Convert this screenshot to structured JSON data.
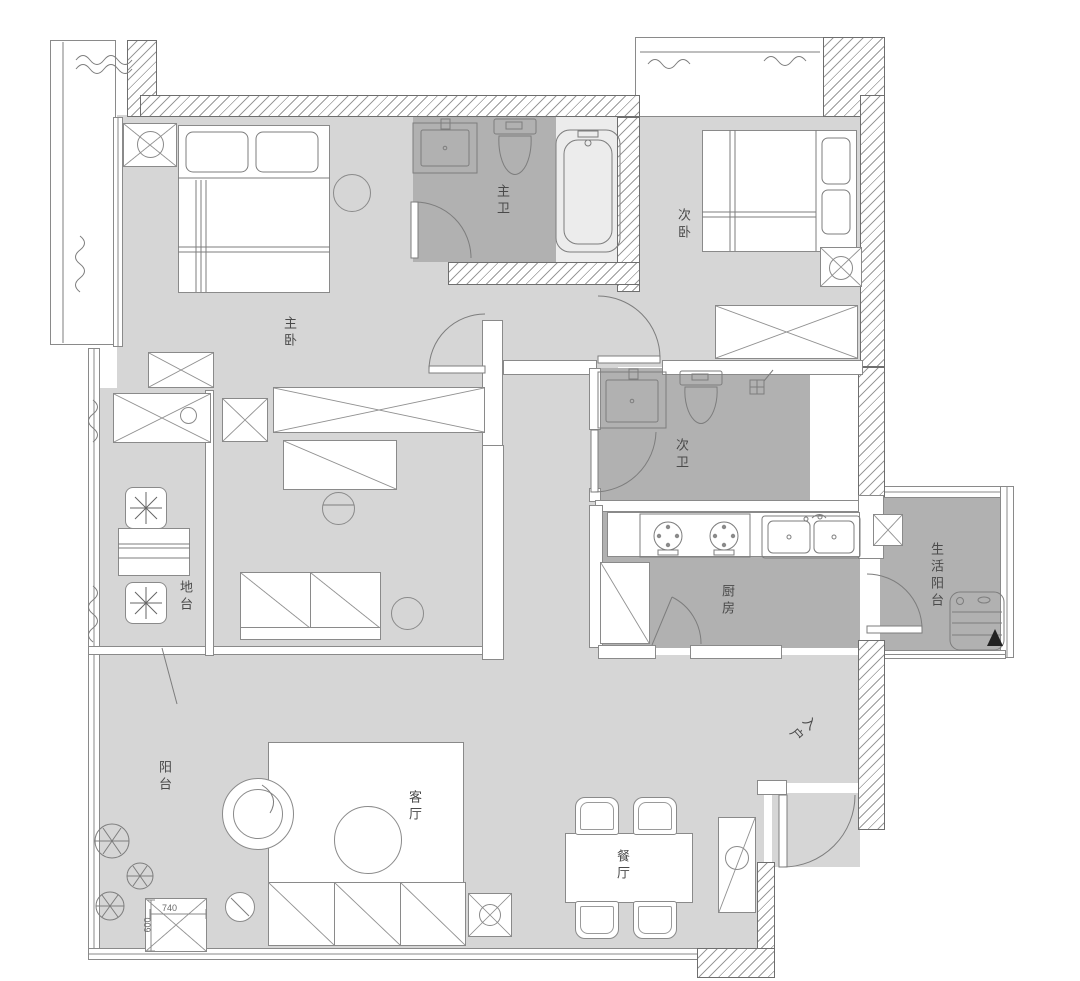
{
  "rooms": {
    "master_bedroom": {
      "label": "主卧"
    },
    "master_bathroom": {
      "label": "主卫"
    },
    "second_bedroom": {
      "label": "次卧"
    },
    "second_bathroom": {
      "label": "次卫"
    },
    "kitchen": {
      "label": "厨房"
    },
    "service_balcony": {
      "label": "生活阳台"
    },
    "platform": {
      "label": "地台"
    },
    "balcony": {
      "label": "阳台"
    },
    "living_room": {
      "label": "客厅"
    },
    "dining_room": {
      "label": "餐厅"
    },
    "entry": {
      "label": "入户"
    }
  },
  "dimensions": {
    "column_width": "740",
    "column_depth": "600"
  },
  "colors": {
    "floor_light": "#d6d6d6",
    "floor_dark": "#b1b1b1",
    "wall_outline": "#6e6e6e",
    "furniture_line": "#8a8a8a",
    "label_text": "#4a4a4a"
  }
}
